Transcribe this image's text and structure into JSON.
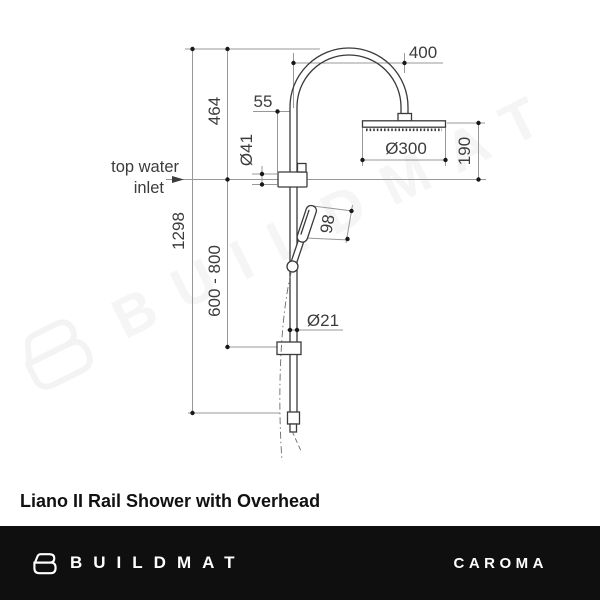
{
  "title": "Liano II Rail Shower with Overhead",
  "watermark": {
    "text": "BUILDMAT"
  },
  "footer": {
    "brand": "BUILDMAT",
    "partner_brand": "CAROMA"
  },
  "diagram": {
    "labels": {
      "inlet_line1": "top water",
      "inlet_line2": "inlet"
    },
    "dims": {
      "arm_reach": "400",
      "top_to_inlet": "464",
      "rail_offset": "55",
      "bracket_dia": "Ø41",
      "head_dia": "Ø300",
      "head_drop": "190",
      "overall_height": "1298",
      "handset_range": "600 - 800",
      "handset_length": "98",
      "rail_dia": "Ø21"
    },
    "colors": {
      "product_line": "#3a3a3a",
      "dimension_line": "#989898",
      "dot": "#181818",
      "text": "#3c3c3c",
      "footer_bg": "#0f0f0f",
      "watermark": "#f5f5f5"
    }
  }
}
